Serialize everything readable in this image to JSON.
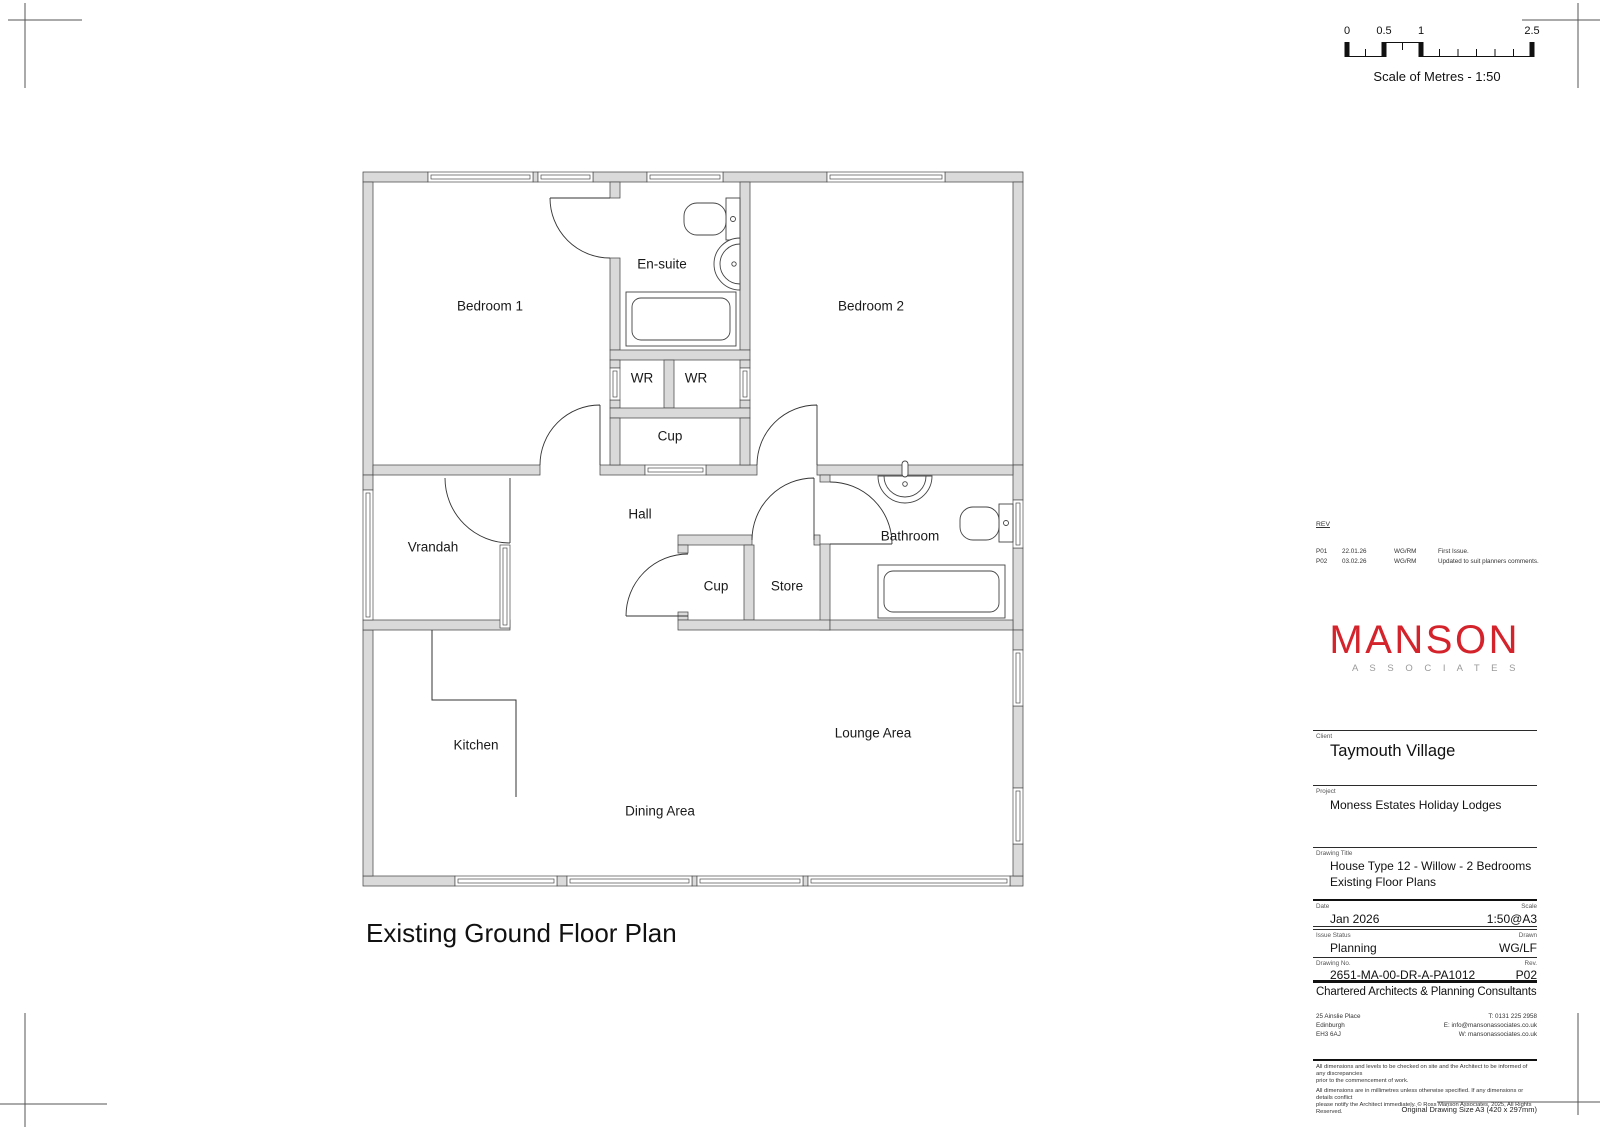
{
  "scale_bar": {
    "ticks": [
      "0",
      "0.5",
      "1",
      "2.5"
    ],
    "caption": "Scale of Metres - 1:50"
  },
  "plan": {
    "title": "Existing Ground Floor Plan",
    "rooms": {
      "bedroom1": "Bedroom 1",
      "ensuite": "En-suite",
      "bedroom2": "Bedroom 2",
      "wr_left": "WR",
      "wr_right": "WR",
      "cup_top": "Cup",
      "hall": "Hall",
      "vrandah": "Vrandah",
      "bathroom": "Bathroom",
      "cup_mid": "Cup",
      "store": "Store",
      "kitchen": "Kitchen",
      "lounge": "Lounge Area",
      "dining": "Dining Area"
    }
  },
  "title_block": {
    "rev": {
      "heading": "REV",
      "entries": [
        {
          "rev": "P01",
          "date": "22.01.26",
          "by": "WG/RM",
          "desc": "First Issue."
        },
        {
          "rev": "P02",
          "date": "03.02.26",
          "by": "WG/RM",
          "desc": "Updated to suit planners comments."
        }
      ]
    },
    "logo": {
      "name": "MANSON",
      "sub": "A S S O C I A T E S",
      "color": "#d5232c"
    },
    "client": {
      "label": "Client",
      "value": "Taymouth Village"
    },
    "project": {
      "label": "Project",
      "value": "Moness Estates Holiday Lodges"
    },
    "drawing_title": {
      "label": "Drawing Title",
      "line1": "House Type 12 - Willow - 2 Bedrooms",
      "line2": "Existing Floor Plans"
    },
    "date": {
      "label": "Date",
      "value": "Jan 2026"
    },
    "scale": {
      "label": "Scale",
      "value": "1:50@A3"
    },
    "issue_status": {
      "label": "Issue Status",
      "value": "Planning"
    },
    "drawn": {
      "label": "Drawn",
      "value": "WG/LF"
    },
    "drawing_no": {
      "label": "Drawing No.",
      "value": "2651-MA-00-DR-A-PA1012"
    },
    "rev_no": {
      "label": "Rev.",
      "value": "P02"
    },
    "tagline": "Chartered Architects & Planning Consultants",
    "address": [
      "25 Ainslie Place",
      "Edinburgh",
      "EH3 6AJ"
    ],
    "contact": [
      "T: 0131 225 2958",
      "E: info@mansonassociates.co.uk",
      "W: mansonassociates.co.uk"
    ],
    "disclaimer": [
      "All dimensions and levels to be checked on site and the Architect to be informed of any discrepancies",
      "prior to the commencement of work.",
      "All dimensions are in millimetres unless otherwise specified. If any dimensions or details conflict",
      "please notify the Architect immediately. © Ross Manson Associates, 2025, All Rights Reserved."
    ],
    "original_size": "Original Drawing Size A3 (420 x 297mm)"
  }
}
